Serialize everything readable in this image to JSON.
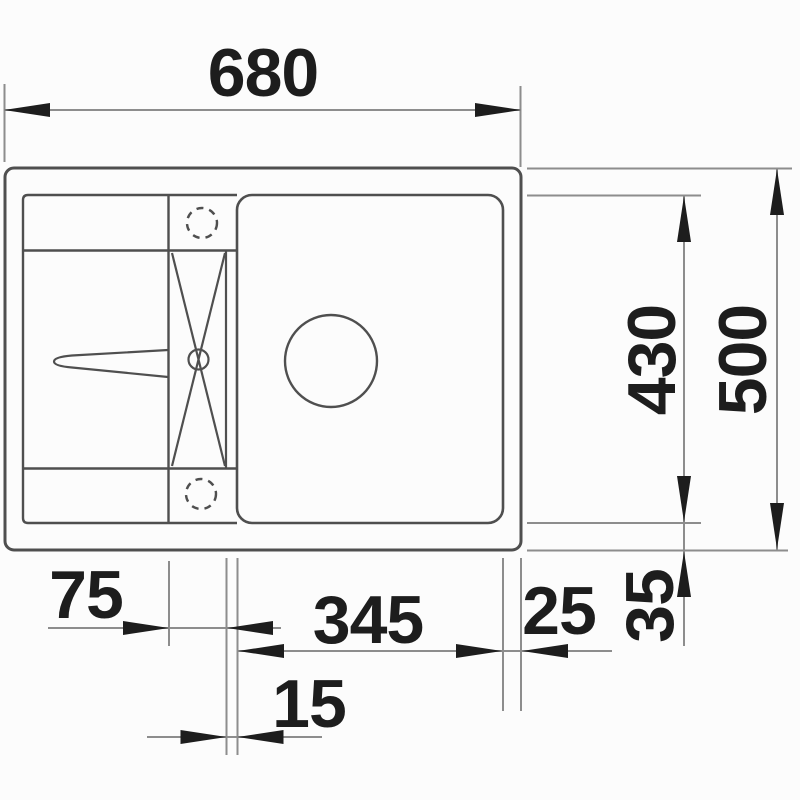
{
  "drawing": {
    "title": "Kitchen sink technical drawing, top view with dimensions",
    "type": "dimension-diagram",
    "units": "mm",
    "colors": {
      "background": "#fcfcfc",
      "outline": "#4f4f4f",
      "dimension_lines": "#8d8d8d",
      "ink": "#1d1d1d"
    },
    "dimensions": {
      "total_width": "680",
      "total_depth": "500",
      "bowl_depth": "430",
      "bowl_width": "345",
      "right_inset": "25",
      "bottom_inset": "35",
      "drainer_segment": "75",
      "gap_segment": "15"
    }
  }
}
